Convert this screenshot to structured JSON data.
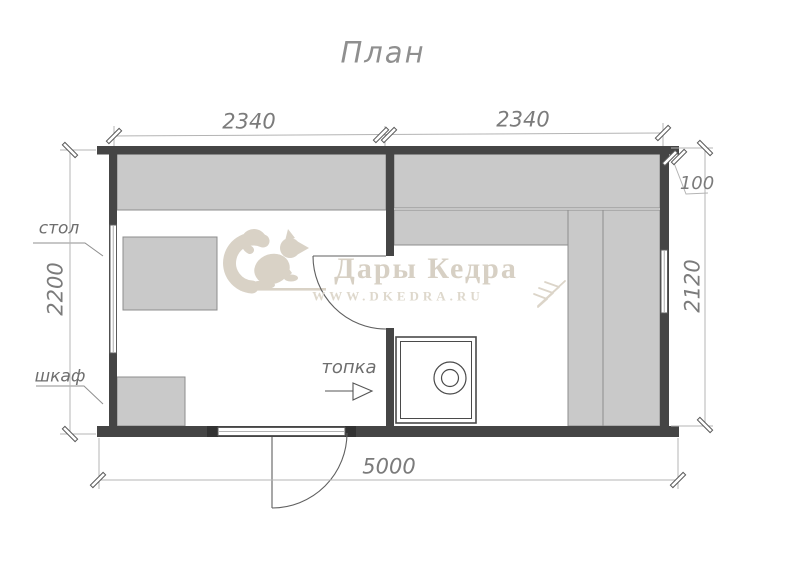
{
  "title": "План",
  "dimensions": {
    "room1_width": "2340",
    "room2_width": "2340",
    "corner_overhang": "100",
    "room1_depth": "2200",
    "room2_depth": "2120",
    "total_length": "5000"
  },
  "labels": {
    "table": "стол",
    "cabinet": "шкаф",
    "firebox": "топка"
  },
  "watermark": {
    "brand": "Дары Кедра",
    "website": "WWW.DKEDRA.RU"
  },
  "colors": {
    "wall": "#454545",
    "furniture_fill": "#c9c9c9",
    "furniture_stroke": "#8d8d8d",
    "line": "#555555",
    "dimension_line": "#b4b4b4",
    "dimension_text": "#7b7b7b",
    "watermark": "#d7d0c4"
  }
}
